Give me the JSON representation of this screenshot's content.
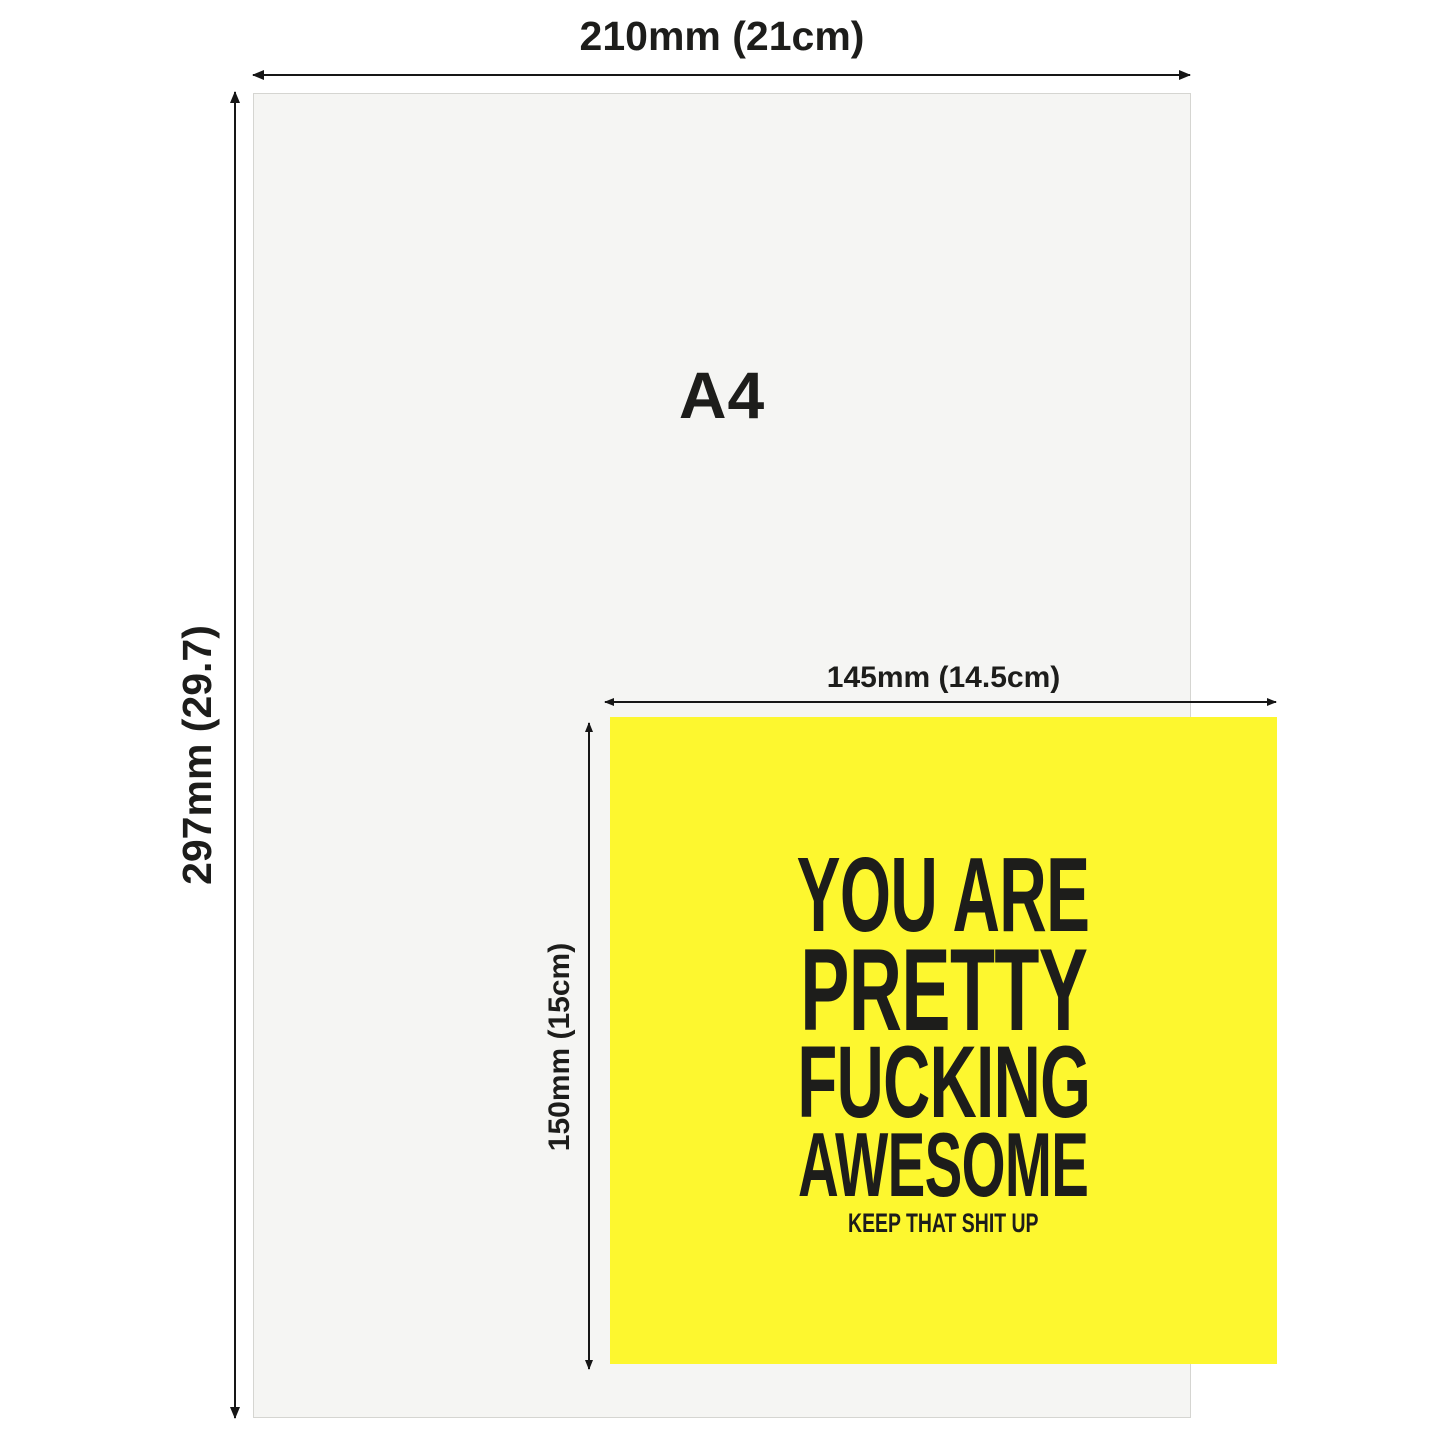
{
  "a4": {
    "label": "A4",
    "width_label": "210mm (21cm)",
    "height_label": "297mm (29.7)",
    "background_color": "#f5f5f3",
    "border_color": "#d5d5d1"
  },
  "card": {
    "width_label": "145mm (14.5cm)",
    "height_label": "150mm (15cm)",
    "headline_lines": [
      "YOU ARE",
      "PRETTY",
      "FUCKING",
      "AWESOME"
    ],
    "tagline": "KEEP THAT SHIT UP",
    "background_color": "#fdf72f",
    "text_color": "#1d1d1b"
  },
  "arrow_color": "#161616"
}
